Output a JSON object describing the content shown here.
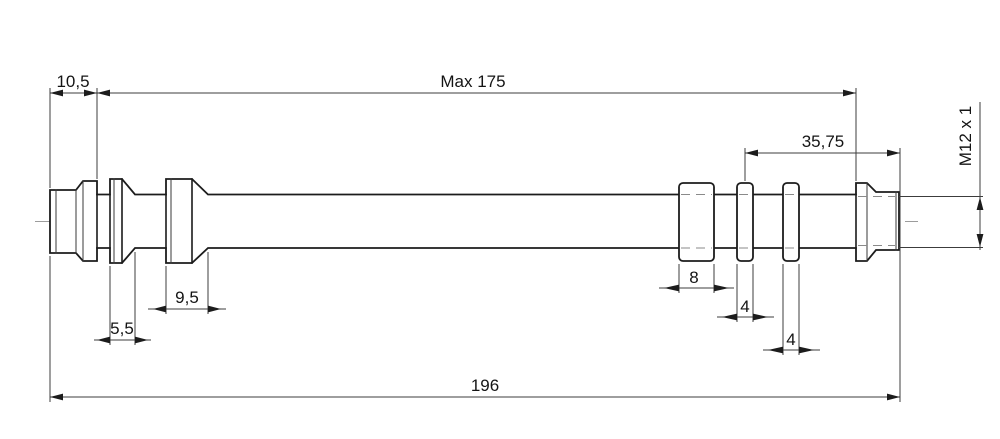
{
  "drawing": {
    "type": "technical-drawing",
    "subject": "stepped shaft with collars and threaded end",
    "colors": {
      "outline": "#1c1c1c",
      "dimension_lines": "#3c3c3c",
      "centerline": "#9c9c9c",
      "hidden_lines": "#8a8a8a",
      "background": "#ffffff"
    },
    "dims": {
      "left_end": "10,5",
      "max_length": "Max 175",
      "thread_section": "35,75",
      "thread_spec": "M12 x 1",
      "large_collar": "9,5",
      "small_collar": "5,5",
      "spacer_width": "8",
      "groove_1": "4",
      "groove_2": "4",
      "overall_length": "196"
    }
  }
}
